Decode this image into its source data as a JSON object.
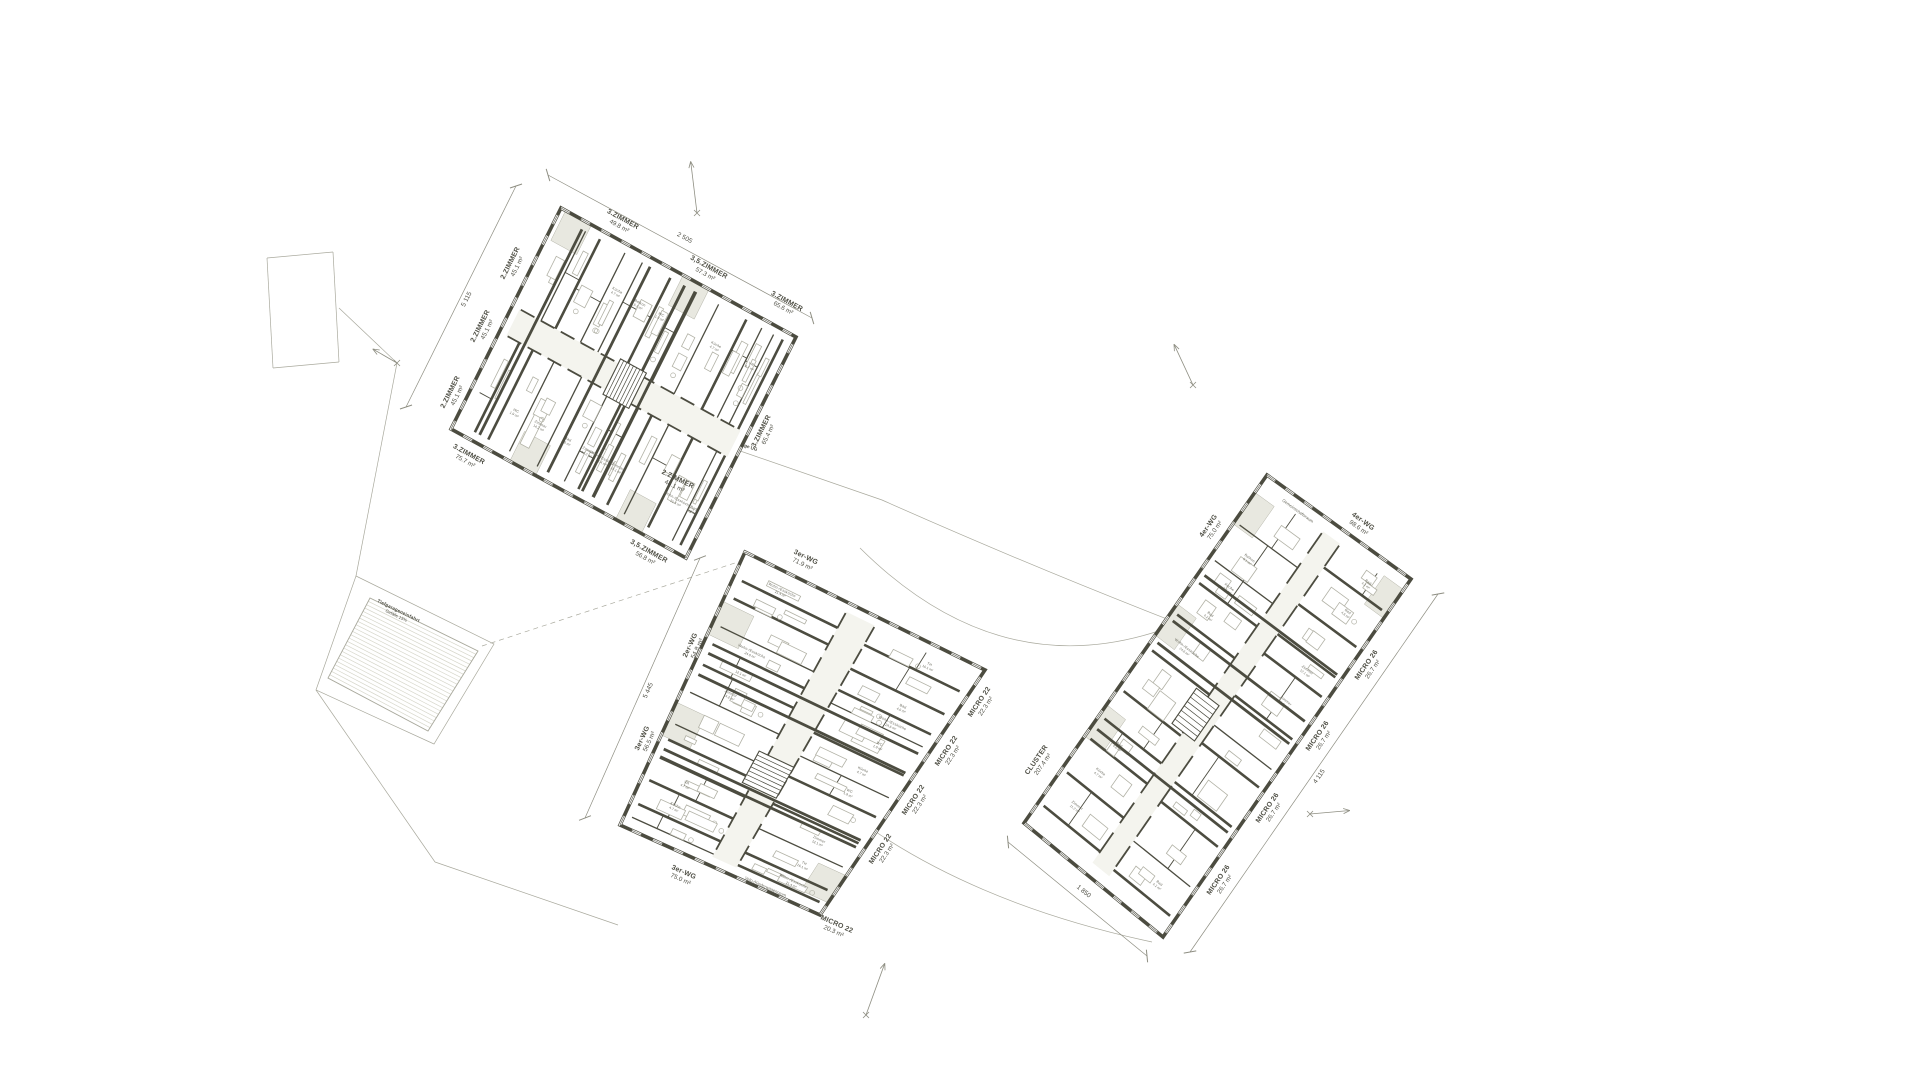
{
  "drawing": {
    "type": "architectural-site-floor-plan",
    "background": "#ffffff"
  },
  "colors": {
    "wall": "#4c4c40",
    "thin": "#9c9c90",
    "furn": "#b2b2a6",
    "balcony": "#e8e8e0",
    "corridor": "#f4f4ee",
    "hatch": "#d6d6ca",
    "boundary": "#a9a99d",
    "dim": "#8e8e82",
    "text": "#4f4f45",
    "room": "#6b6b5f"
  },
  "room_label_pool": [
    {
      "name": "Zimmer",
      "area": "11.2 m²"
    },
    {
      "name": "Zimmer",
      "area": "14.2 m²"
    },
    {
      "name": "Zimmer",
      "area": "12.1 m²"
    },
    {
      "name": "Zimmer",
      "area": "15.1 m²"
    },
    {
      "name": "Bad",
      "area": "4.2 m²"
    },
    {
      "name": "Bad",
      "area": "4.6 m²"
    },
    {
      "name": "VR",
      "area": "4.7 m²"
    },
    {
      "name": "WC",
      "area": "1.9 m²"
    },
    {
      "name": "Küche",
      "area": "4.7 m²"
    },
    {
      "name": "Wohn-/Essküche",
      "area": "21.4 m²"
    },
    {
      "name": "Wohn-/Essküche",
      "area": "24.6 m²"
    },
    {
      "name": "Balkon",
      "area": "5.1 m²"
    },
    {
      "name": "TH",
      "area": "16.1 m²"
    },
    {
      "name": "Gang",
      "area": "7.3 m²"
    }
  ],
  "buildings": [
    {
      "id": "building-west",
      "seed": 11,
      "axis": "u",
      "corners": [
        [
          561,
          208
        ],
        [
          796,
          337
        ],
        [
          686,
          558
        ],
        [
          451,
          429
        ]
      ],
      "stair": {
        "a0": 0.45,
        "a1": 0.56,
        "c0": 0.42,
        "c1": 0.58
      },
      "balconies": [
        {
          "a0": 0.02,
          "a1": 0.13,
          "side": 0
        },
        {
          "a0": 0.52,
          "a1": 0.63,
          "side": 0
        },
        {
          "a0": 0.25,
          "a1": 0.36,
          "side": 1
        },
        {
          "a0": 0.7,
          "a1": 0.81,
          "side": 1
        }
      ],
      "units": [
        {
          "x": 622,
          "y": 221,
          "rot": 28.8,
          "lines": [
            "3.ZIMMER",
            "49.8 m²"
          ]
        },
        {
          "x": 708,
          "y": 269,
          "rot": 28.8,
          "lines": [
            "3,5.ZIMMER",
            "57.3 m²"
          ]
        },
        {
          "x": 786,
          "y": 303,
          "rot": 28.8,
          "lines": [
            "3.ZIMMER",
            "65.6 m²"
          ]
        },
        {
          "x": 512,
          "y": 264,
          "rot": -63.5,
          "lines": [
            "2.ZIMMER",
            "45.1 m²"
          ]
        },
        {
          "x": 482,
          "y": 327,
          "rot": -63.5,
          "lines": [
            "2.ZIMMER",
            "45.1 m²"
          ]
        },
        {
          "x": 452,
          "y": 393,
          "rot": -63.5,
          "lines": [
            "2.ZIMMER",
            "45.1 m²"
          ]
        },
        {
          "x": 468,
          "y": 456,
          "rot": 28.8,
          "lines": [
            "3.ZIMMER",
            "75.7 m²"
          ]
        },
        {
          "x": 648,
          "y": 553,
          "rot": 28.8,
          "lines": [
            "3,5.ZIMMER",
            "56.8 m²"
          ]
        },
        {
          "x": 763,
          "y": 432,
          "rot": -63.5,
          "lines": [
            "3.ZIMMER",
            "65.4 m²"
          ]
        }
      ]
    },
    {
      "id": "building-middle",
      "seed": 23,
      "axis": "v",
      "corners": [
        [
          745,
          552
        ],
        [
          985,
          670
        ],
        [
          820,
          915
        ],
        [
          620,
          825
        ]
      ],
      "stair": {
        "a0": 0.58,
        "a1": 0.7,
        "c0": 0.4,
        "c1": 0.56
      },
      "balconies": [
        {
          "a0": 0.18,
          "a1": 0.3,
          "side": 0
        },
        {
          "a0": 0.55,
          "a1": 0.67,
          "side": 0
        },
        {
          "a0": 0.84,
          "a1": 0.95,
          "side": 1
        }
      ],
      "units": [
        {
          "x": 677,
          "y": 481,
          "rot": 26,
          "lines": [
            "2.ZIMMER",
            "48.1 m²"
          ]
        },
        {
          "x": 805,
          "y": 559,
          "rot": 26,
          "lines": [
            "3er-WG",
            "71.9 m²"
          ]
        },
        {
          "x": 692,
          "y": 646,
          "rot": -65,
          "lines": [
            "2er-WG",
            "54.8 m²"
          ]
        },
        {
          "x": 644,
          "y": 739,
          "rot": -65,
          "lines": [
            "3er-WG",
            "56.5 m²"
          ]
        },
        {
          "x": 683,
          "y": 874,
          "rot": 24,
          "lines": [
            "3er-WG",
            "75.0 m²"
          ]
        },
        {
          "x": 981,
          "y": 703,
          "rot": -56,
          "lines": [
            "MICRO 22",
            "22.3 m²"
          ]
        },
        {
          "x": 948,
          "y": 752,
          "rot": -56,
          "lines": [
            "MICRO 22",
            "22.3 m²"
          ]
        },
        {
          "x": 915,
          "y": 801,
          "rot": -56,
          "lines": [
            "MICRO 22",
            "22.3 m²"
          ]
        },
        {
          "x": 882,
          "y": 850,
          "rot": -56,
          "lines": [
            "MICRO 22",
            "22.3 m²"
          ]
        },
        {
          "x": 836,
          "y": 926,
          "rot": 24,
          "lines": [
            "MICRO 22",
            "20.3 m²"
          ]
        }
      ]
    },
    {
      "id": "building-east",
      "seed": 5,
      "axis": "v",
      "corners": [
        [
          1267,
          475
        ],
        [
          1411,
          579
        ],
        [
          1163,
          937
        ],
        [
          1024,
          823
        ]
      ],
      "stair": {
        "a0": 0.5,
        "a1": 0.6,
        "c0": 0.36,
        "c1": 0.52
      },
      "balconies": [
        {
          "a0": 0.05,
          "a1": 0.14,
          "side": 0
        },
        {
          "a0": 0.37,
          "a1": 0.46,
          "side": 0
        },
        {
          "a0": 0.66,
          "a1": 0.75,
          "side": 0
        },
        {
          "a0": 0.03,
          "a1": 0.11,
          "side": 1
        }
      ],
      "units": [
        {
          "x": 1210,
          "y": 527,
          "rot": -55,
          "lines": [
            "4er-WG",
            "75.0 m²"
          ]
        },
        {
          "x": 1362,
          "y": 523,
          "rot": 35.8,
          "lines": [
            "4er-WG",
            "98.6 m²"
          ]
        },
        {
          "x": 1038,
          "y": 761,
          "rot": -55,
          "lines": [
            "CLUSTER",
            "207.4 m²"
          ]
        },
        {
          "x": 1368,
          "y": 666,
          "rot": -55,
          "lines": [
            "MICRO 26",
            "26.7 m²"
          ]
        },
        {
          "x": 1319,
          "y": 737,
          "rot": -55,
          "lines": [
            "MICRO 26",
            "26.7 m²"
          ]
        },
        {
          "x": 1269,
          "y": 809,
          "rot": -55,
          "lines": [
            "MICRO 26",
            "26.7 m²"
          ]
        },
        {
          "x": 1220,
          "y": 881,
          "rot": -55,
          "lines": [
            "MICRO 26",
            "26.7 m²"
          ]
        }
      ]
    }
  ],
  "site": {
    "parcel_lines": [
      [
        267,
        258,
        333,
        252
      ],
      [
        333,
        252,
        339,
        362
      ],
      [
        339,
        362,
        273,
        368
      ],
      [
        273,
        368,
        267,
        258
      ],
      [
        339,
        308,
        397,
        363
      ],
      [
        397,
        363,
        356,
        576
      ],
      [
        316,
        690,
        435,
        862
      ],
      [
        435,
        862,
        618,
        925
      ]
    ],
    "dashed_lines": [
      [
        482,
        646,
        744,
        560
      ]
    ],
    "curves": [
      "M616,408 L882,500 Q1035,568 1180,624",
      "M860,548 Q1005,692 1178,624",
      "M873,830 Q985,906 1152,942"
    ],
    "ramp": {
      "outline": [
        [
          370,
          598
        ],
        [
          478,
          651
        ],
        [
          428,
          731
        ],
        [
          328,
          678
        ]
      ],
      "outer": [
        [
          356,
          576
        ],
        [
          494,
          644
        ],
        [
          434,
          744
        ],
        [
          316,
          690
        ]
      ],
      "label": [
        "Tiefgarageneinfahrt",
        "Gefälle 15%"
      ],
      "label_pos": [
        398,
        612
      ],
      "label_rot": 26
    },
    "path_label": {
      "text": "Tiefgarage UG",
      "x": 742,
      "y": 446,
      "rot": 19
    },
    "extra_labels": [
      {
        "text": "Velo-/Kinderwagenraum",
        "x": 765,
        "y": 888,
        "rot": 24
      },
      {
        "text": "Gemeinschaftsraum",
        "x": 1297,
        "y": 512,
        "rot": 36
      }
    ],
    "dims": [
      {
        "x1": 548,
        "y1": 175,
        "x2": 812,
        "y2": 318,
        "label": "2 505"
      },
      {
        "x1": 516,
        "y1": 186,
        "x2": 406,
        "y2": 407,
        "label": "5 115"
      },
      {
        "x1": 700,
        "y1": 558,
        "x2": 585,
        "y2": 818,
        "label": "5 445"
      },
      {
        "x1": 1438,
        "y1": 594,
        "x2": 1190,
        "y2": 952,
        "label": "4 115"
      },
      {
        "x1": 1008,
        "y1": 842,
        "x2": 1147,
        "y2": 956,
        "label": "1 850"
      }
    ],
    "markers": [
      {
        "x": 697,
        "y": 213,
        "angle": -97,
        "len": 52
      },
      {
        "x": 1193,
        "y": 385,
        "angle": -115,
        "len": 45
      },
      {
        "x": 866,
        "y": 1015,
        "angle": -70,
        "len": 55
      },
      {
        "x": 1310,
        "y": 814,
        "angle": -5,
        "len": 40
      },
      {
        "x": 397,
        "y": 363,
        "angle": -150,
        "len": 28
      }
    ]
  }
}
